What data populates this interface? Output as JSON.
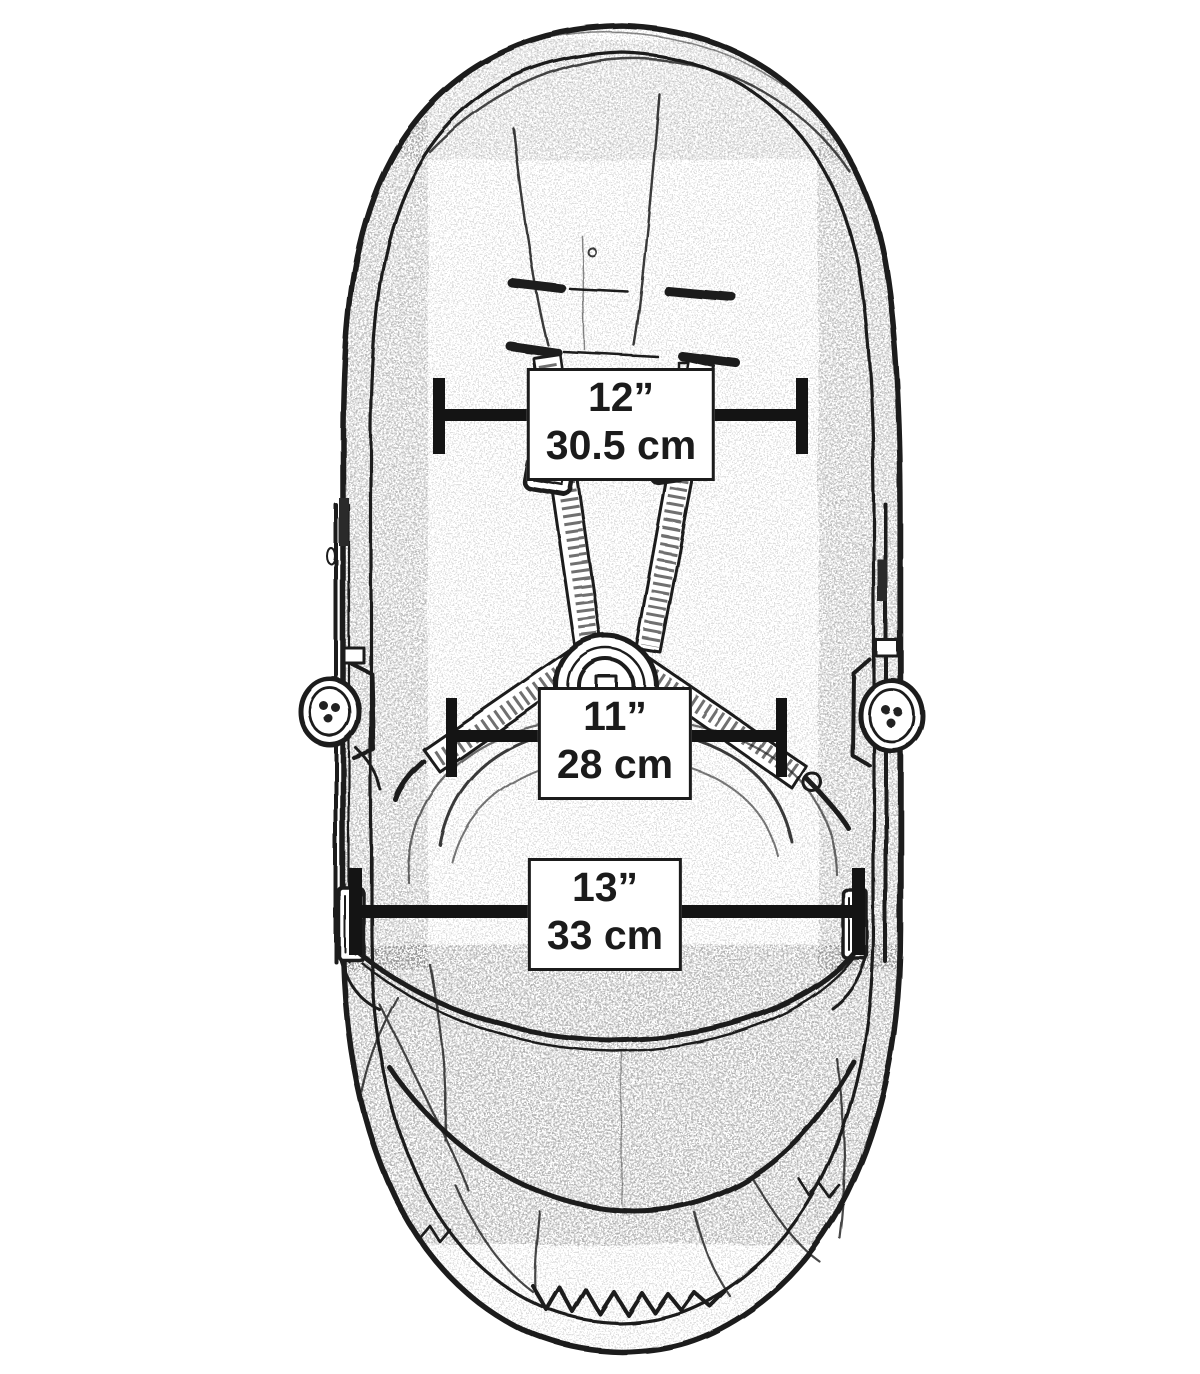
{
  "figure": {
    "colors": {
      "ink": "#1b1b1b",
      "background": "#ffffff",
      "label_background": "#ffffff",
      "label_border": "#1b1b1b",
      "dimension_line": "#141414"
    },
    "measurements": [
      {
        "position": "top",
        "inches": "12”",
        "metric": "30.5 cm"
      },
      {
        "position": "middle",
        "inches": "11”",
        "metric": "28 cm"
      },
      {
        "position": "bottom",
        "inches": "13”",
        "metric": "33 cm"
      }
    ]
  }
}
